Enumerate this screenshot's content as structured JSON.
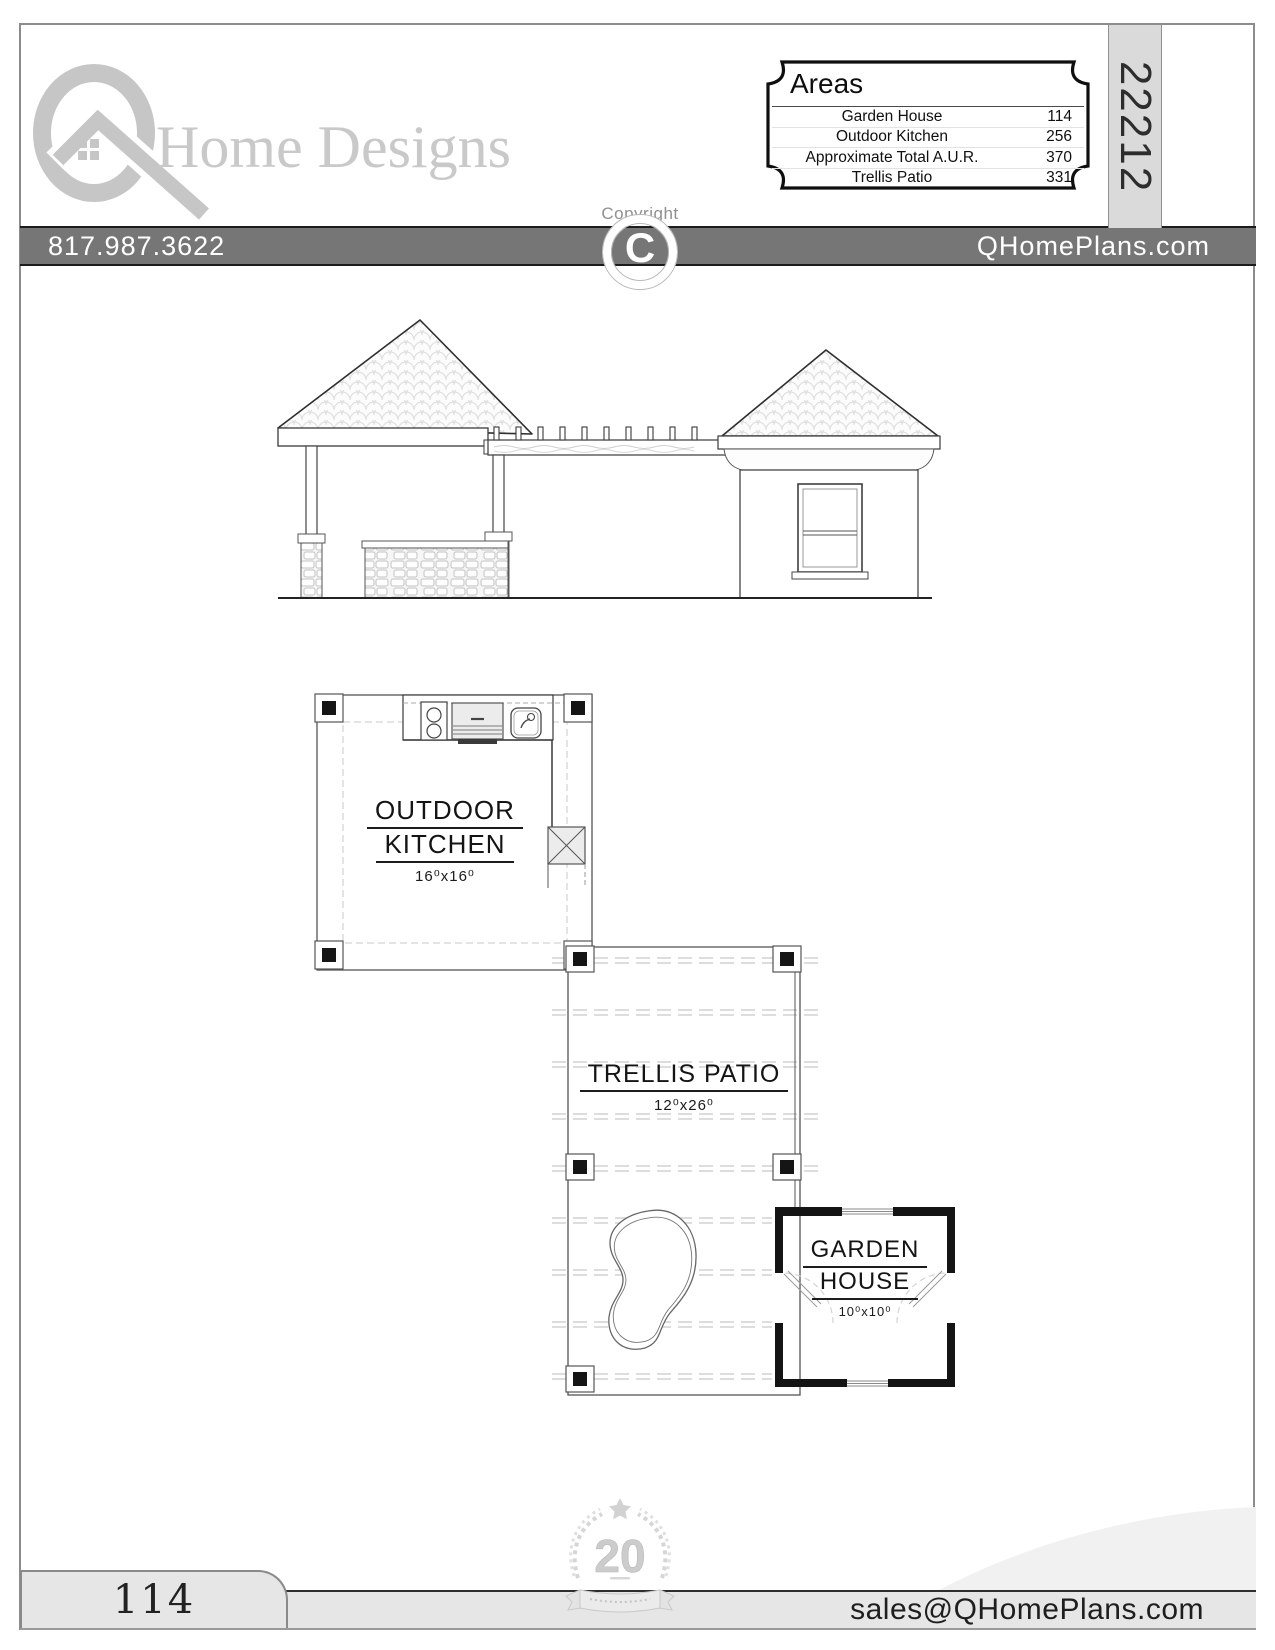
{
  "header": {
    "brand": "Home Designs",
    "phone": "817.987.3622",
    "website": "QHomePlans.com",
    "copyright_label": "Copyright",
    "copyright_symbol": "C",
    "plan_number": "22212"
  },
  "areas": {
    "title": "Areas",
    "rows": [
      {
        "label": "Garden House",
        "value": "114"
      },
      {
        "label": "Outdoor Kitchen",
        "value": "256"
      },
      {
        "label": "Approximate Total A.U.R.",
        "value": "370"
      },
      {
        "label": "Trellis Patio",
        "value": "331"
      }
    ]
  },
  "plan": {
    "outdoor_kitchen": {
      "line1": "OUTDOOR",
      "line2": "KITCHEN",
      "dims": "16⁰x16⁰"
    },
    "trellis_patio": {
      "line1": "TRELLIS PATIO",
      "dims": "12⁰x26⁰"
    },
    "garden_house": {
      "line1": "GARDEN",
      "line2": "HOUSE",
      "dims": "10⁰x10⁰"
    }
  },
  "footer": {
    "page_number": "114",
    "email": "sales@QHomePlans.com",
    "anniversary_number": "20"
  },
  "colors": {
    "header_bar": "#767676",
    "logo_gray": "#c6c6c6",
    "footer_bar": "#e6e6e6",
    "plan_strip": "#dadada"
  }
}
